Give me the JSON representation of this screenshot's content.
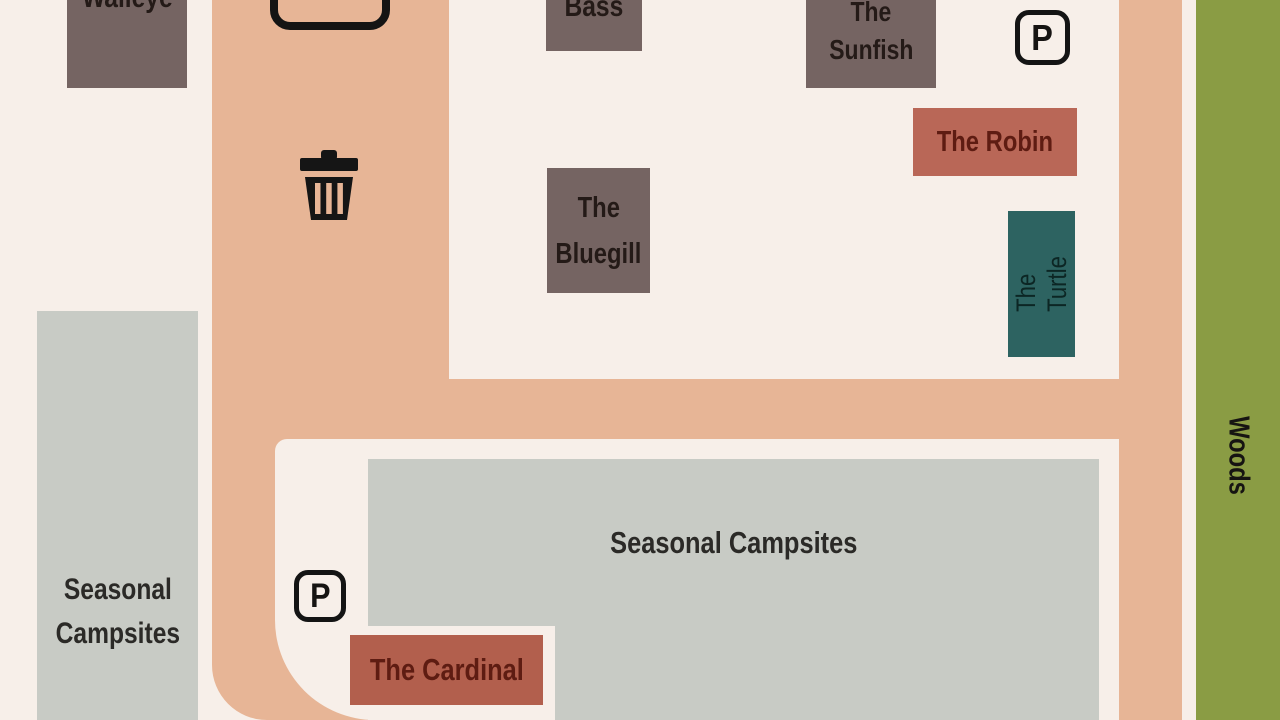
{
  "palette": {
    "background": "#f7efe9",
    "road": "#e7b596",
    "cabin_brown": "#756462",
    "cabin_red": "#b96757",
    "cabin_red_dark": "#b25f4d",
    "cabin_teal": "#2d6361",
    "campsite_gray": "#c8cbc5",
    "woods_green": "#8a9c44",
    "ink": "#161412"
  },
  "areas": {
    "woods": {
      "label": "Woods"
    },
    "seasonal_campsites_left": {
      "lines": [
        "Seasonal",
        "Campsites"
      ]
    },
    "seasonal_campsites_main": {
      "label": "Seasonal Campsites"
    }
  },
  "cabins": {
    "walleye": {
      "label": "Walleye"
    },
    "bass": {
      "label": "Bass"
    },
    "sunfish": {
      "lines": [
        "The",
        "Sunfish"
      ]
    },
    "bluegill": {
      "lines": [
        "The",
        "Bluegill"
      ]
    },
    "robin": {
      "label": "The Robin"
    },
    "turtle": {
      "label": "The Turtle"
    },
    "cardinal": {
      "label": "The Cardinal"
    }
  },
  "signs": {
    "parking_top": "P",
    "parking_bottom": "P"
  }
}
